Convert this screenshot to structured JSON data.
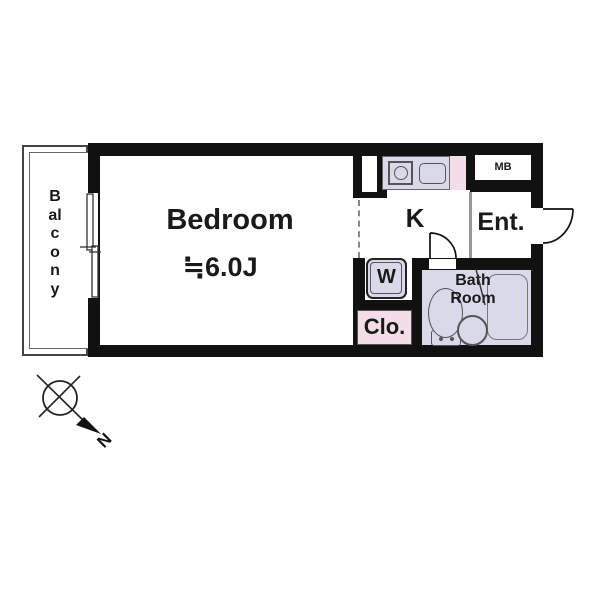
{
  "plan": {
    "balcony_label": "Balcony",
    "bedroom_label": "Bedroom",
    "bedroom_size": "≒6.0J",
    "kitchen_label": "K",
    "entrance_label": "Ent.",
    "meter_box_label": "MB",
    "washer_label": "W",
    "closet_label": "Clo.",
    "bathroom_label_line1": "Bath",
    "bathroom_label_line2": "Room",
    "compass_north_label": "N"
  },
  "colors": {
    "wall": "#111111",
    "fixture_fill": "#d9d9ea",
    "closet_fill": "#f3dde6",
    "divider_gray": "#979797",
    "background": "#ffffff"
  }
}
